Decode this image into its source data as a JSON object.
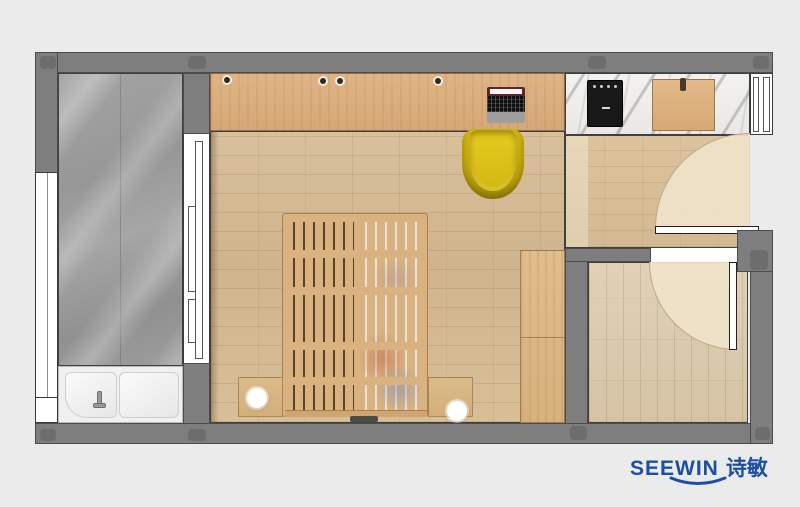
{
  "logo": {
    "brand": "SEEWIN",
    "brand_cn": "诗敏",
    "color": "#1c4fa3"
  },
  "palette": {
    "background": "#ebebeb",
    "wall": "#7e7e7e",
    "wall_column": "#6d6d6d",
    "bathroom_marble": "#9b9b9b",
    "kitchen_marble": "#f1f0ee",
    "bedroom_floor": "#d4ba92",
    "kitchen_floor": "#d8bf99",
    "entry_floor": "#dbcaae",
    "desk_wood": "#dcb183",
    "bed_wood": "#d9b27f",
    "wardrobe_wood": "#dbb884",
    "cutting_board": "#dcb282",
    "chair": "#d4ba17",
    "cooktop": "#181818",
    "bathtub": "#f0f0f0",
    "door_leaf": "#ffffff",
    "door_swing": "#f0e3ca"
  },
  "elements": {
    "rooms": [
      "bathroom",
      "bedroom",
      "kitchen",
      "entry-hall"
    ],
    "furniture": [
      "bathtub",
      "sliding-door",
      "desk",
      "laptop",
      "desk-chair",
      "platform-bed",
      "nightstand-left",
      "nightstand-right",
      "lamp-left",
      "lamp-right",
      "wardrobe",
      "cooktop",
      "cutting-board",
      "entry-door",
      "interior-door"
    ]
  }
}
